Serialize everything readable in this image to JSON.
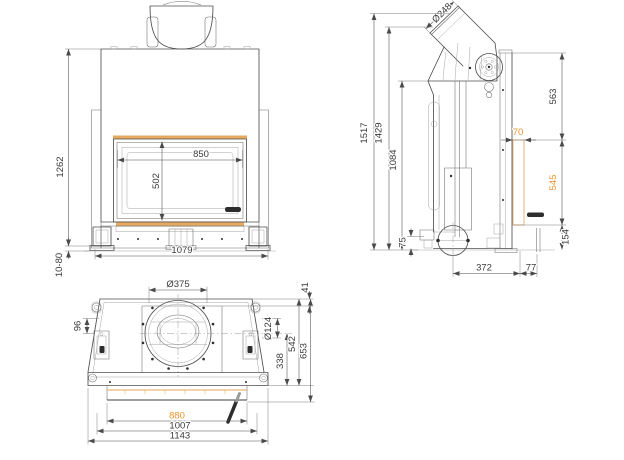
{
  "drawing": {
    "kind": "technical-orthographic-drawing",
    "subject": "fireplace insert with angled flue outlet",
    "colors": {
      "accent_text": "#E8952F",
      "accent_line": "#E3A455",
      "line": "#4A4A4A",
      "background": "#FFFFFF"
    }
  },
  "front_view": {
    "dims": {
      "overall_height": "1262",
      "leg_adjust": "10-80",
      "glass_width": "850",
      "glass_height": "502",
      "base_width": "1079"
    }
  },
  "side_view": {
    "dims": {
      "flue_diameter": "Ø248",
      "overall_height": "1517",
      "flue_face_height": "1429",
      "body_height": "1084",
      "intake_offset": "75",
      "upper_rear_height": "563",
      "rear_panel_offset": "70",
      "rear_panel_height": "545",
      "base_rear_height": "154",
      "intake_to_rear": "372",
      "rear_clearance": "77"
    }
  },
  "bottom_view": {
    "dims": {
      "collar_diameter": "Ø375",
      "side_offset": "96",
      "rear_offset": "41",
      "side_opening_diameter": "Ø124",
      "center_to_front": "338",
      "rear_to_front": "542",
      "overall_depth": "653",
      "glass_width": "880",
      "body_width": "1007",
      "overall_width": "1143"
    }
  }
}
